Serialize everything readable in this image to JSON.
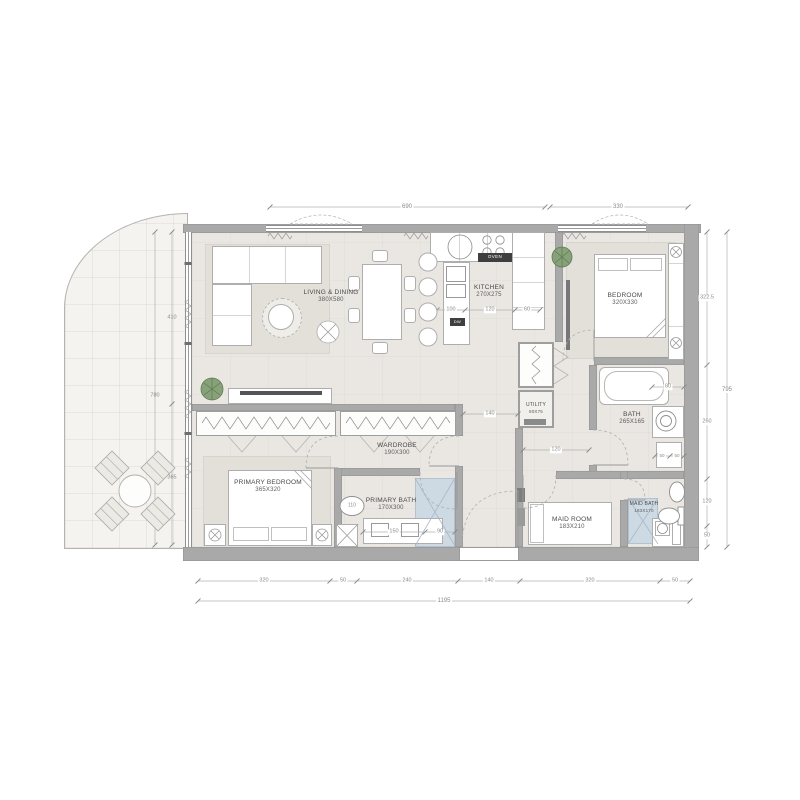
{
  "rooms": {
    "living_dining": {
      "name": "LIVING & DINING",
      "size": "380X580"
    },
    "kitchen": {
      "name": "KITCHEN",
      "size": "270X275"
    },
    "bedroom": {
      "name": "BEDROOM",
      "size": "320X330"
    },
    "bath": {
      "name": "BATH",
      "size": "265X165"
    },
    "utility": {
      "name": "UTILITY",
      "size": "80X75"
    },
    "wardrobe": {
      "name": "WARDROBE",
      "size": "190X300"
    },
    "primary_bedroom": {
      "name": "PRIMARY BEDROOM",
      "size": "365X320"
    },
    "primary_bath": {
      "name": "PRIMARY BATH",
      "size": "170X300"
    },
    "maid_room": {
      "name": "MAID ROOM",
      "size": "183X210"
    },
    "maid_bath": {
      "name": "MAID BATH",
      "size": "183X170"
    }
  },
  "appliances": {
    "oven": "OVEN",
    "dishwasher": "DW"
  },
  "dims": {
    "top": [
      "690",
      "330"
    ],
    "right": [
      "322.5",
      "260",
      "120",
      "50"
    ],
    "right_total": "795",
    "bottom": [
      "320",
      "50",
      "240",
      "140",
      "320",
      "50"
    ],
    "bottom_total": "1195",
    "balcony": [
      "410",
      "365"
    ],
    "balcony_total": "780",
    "kitchen": [
      "100",
      "120",
      "60"
    ],
    "primary_bath": [
      "110",
      "150",
      "90"
    ],
    "hall_width": "140",
    "corridor_width": "120",
    "bath_tub": "80",
    "bath_wc": [
      "50",
      "50"
    ]
  },
  "colors": {
    "wall": "#a9a9a9",
    "floor": "#eae7e2",
    "balcony": "#f4f3f0",
    "rug": "#e3e0da",
    "shower": "#cdd9e3",
    "plant": "#87a178",
    "dim_text": "#8a8a8a",
    "label_text": "#4a4a4a"
  }
}
